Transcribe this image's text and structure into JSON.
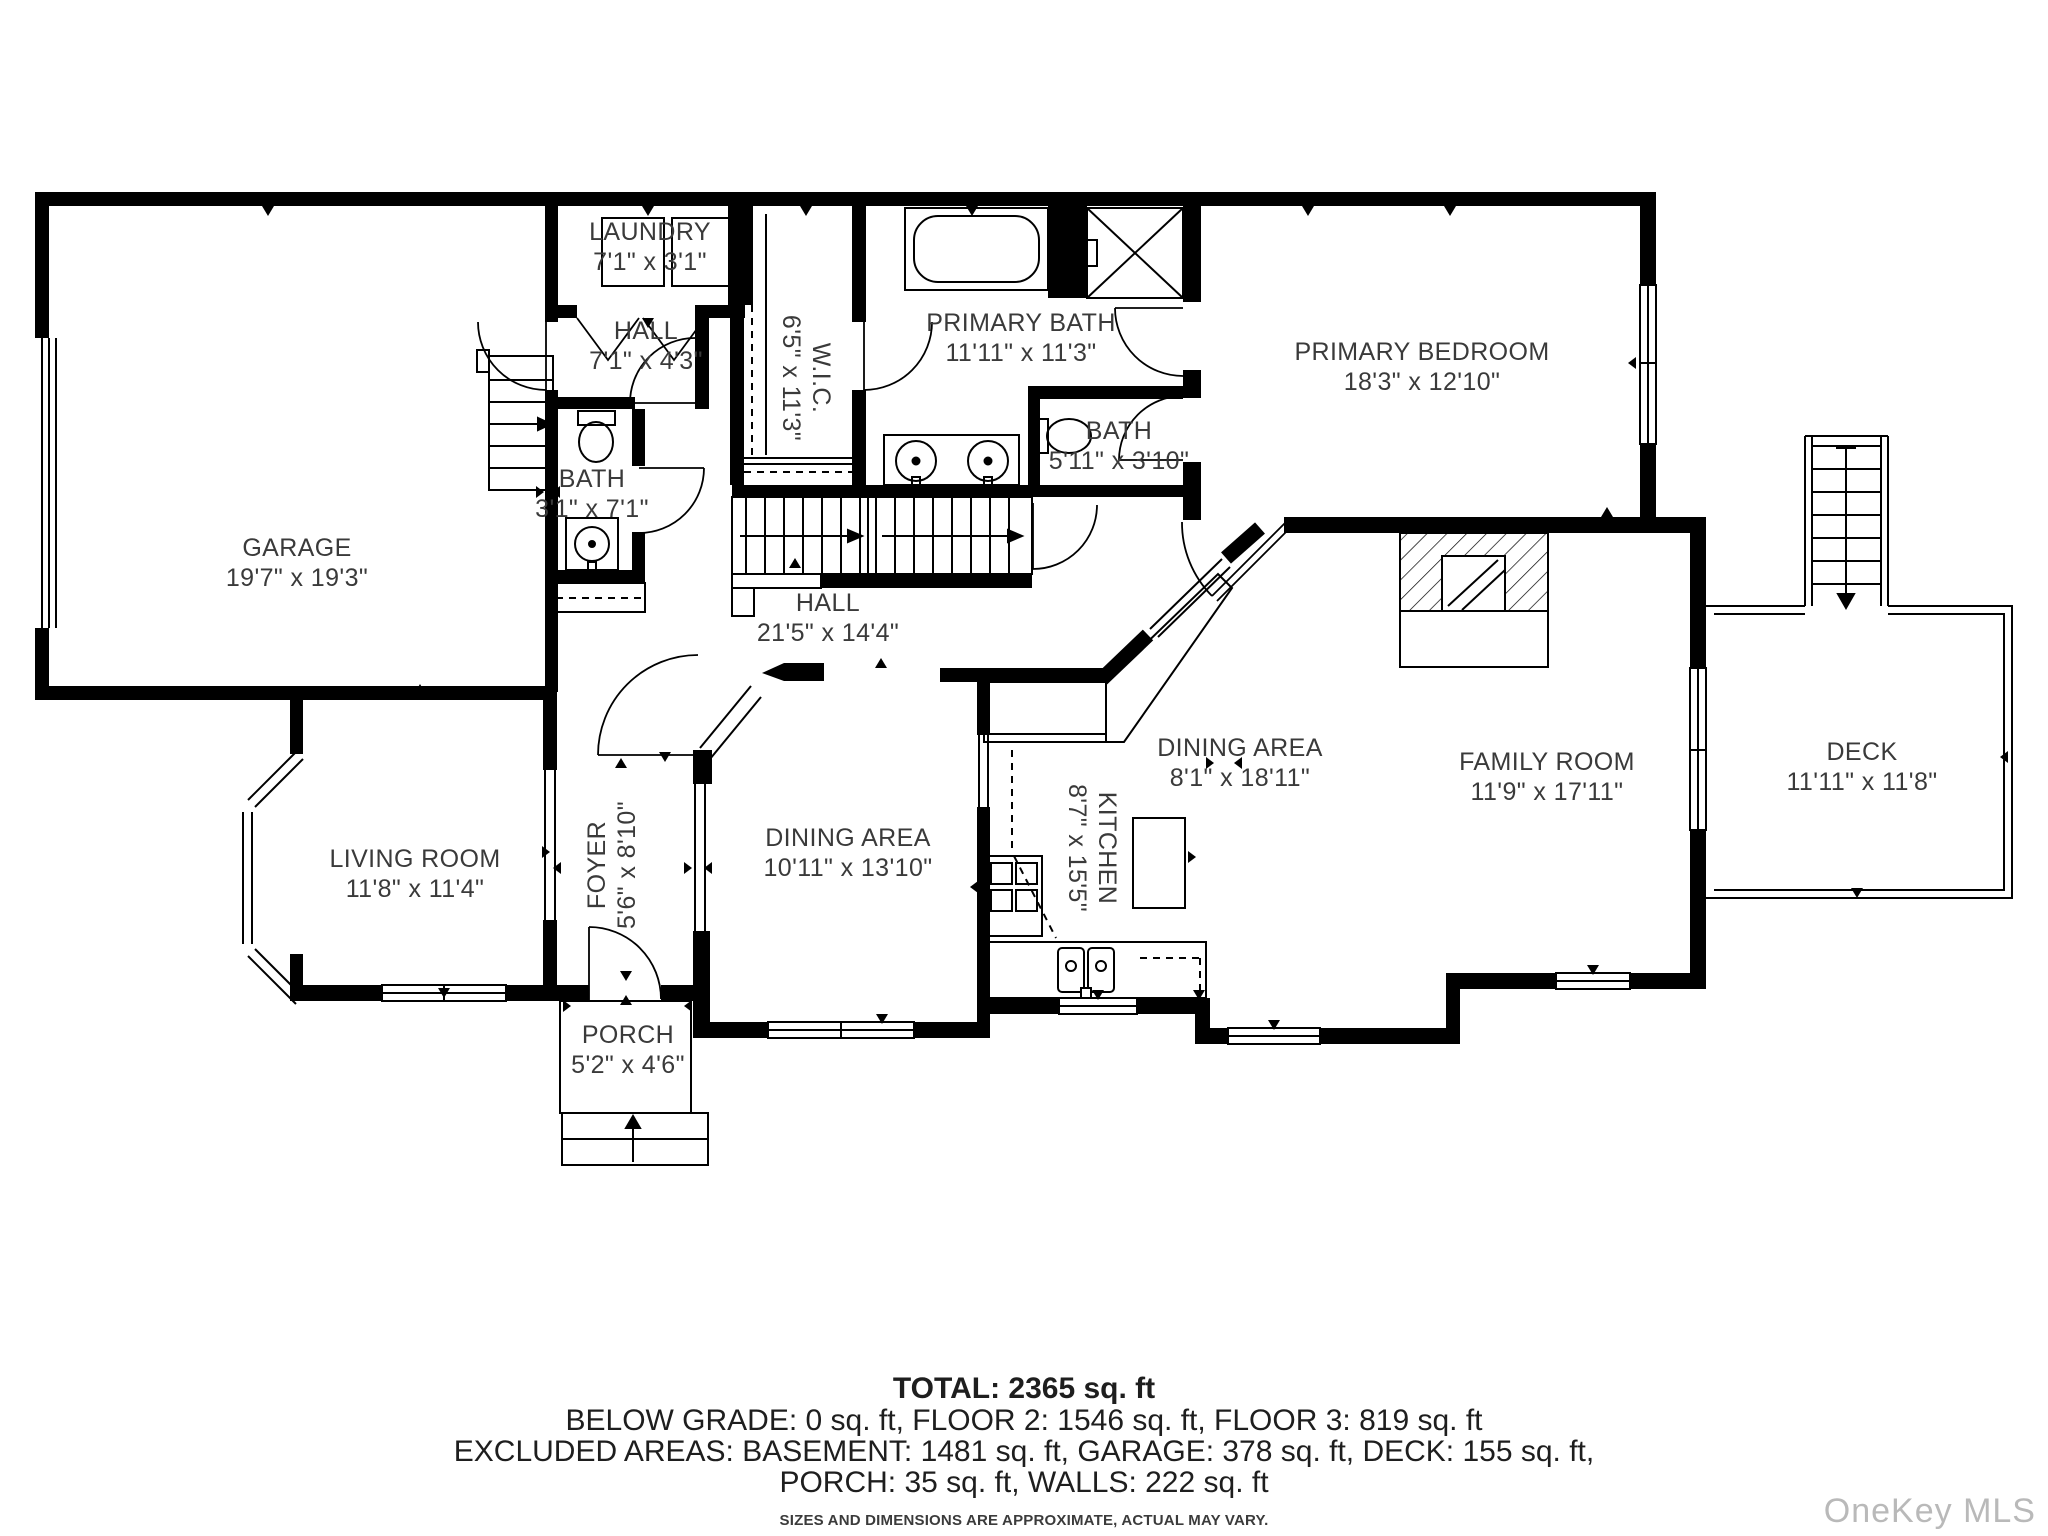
{
  "plan": {
    "rooms": [
      {
        "id": "garage",
        "name": "GARAGE",
        "dims": "19'7\" x 19'3\""
      },
      {
        "id": "laundry",
        "name": "LAUNDRY",
        "dims": "7'1\" x 3'1\""
      },
      {
        "id": "hall-upper",
        "name": "HALL",
        "dims": "7'1\" x 4'3\""
      },
      {
        "id": "bath-1",
        "name": "BATH",
        "dims": "3'1\" x 7'1\""
      },
      {
        "id": "wic",
        "name": "W.I.C.",
        "dims": "6'5\" x 11'3\""
      },
      {
        "id": "primary-bath",
        "name": "PRIMARY BATH",
        "dims": "11'11\" x 11'3\""
      },
      {
        "id": "bath-2",
        "name": "BATH",
        "dims": "5'11\" x 3'10\""
      },
      {
        "id": "primary-bedroom",
        "name": "PRIMARY BEDROOM",
        "dims": "18'3\" x 12'10\""
      },
      {
        "id": "hall-main",
        "name": "HALL",
        "dims": "21'5\" x 14'4\""
      },
      {
        "id": "foyer",
        "name": "FOYER",
        "dims": "5'6\" x 8'10\""
      },
      {
        "id": "living-room",
        "name": "LIVING ROOM",
        "dims": "11'8\" x 11'4\""
      },
      {
        "id": "dining-area-1",
        "name": "DINING AREA",
        "dims": "10'11\" x 13'10\""
      },
      {
        "id": "kitchen",
        "name": "KITCHEN",
        "dims": "8'7\" x 15'5\""
      },
      {
        "id": "dining-area-2",
        "name": "DINING AREA",
        "dims": "8'1\" x 18'11\""
      },
      {
        "id": "family-room",
        "name": "FAMILY ROOM",
        "dims": "11'9\" x 17'11\""
      },
      {
        "id": "deck",
        "name": "DECK",
        "dims": "11'11\" x 11'8\""
      },
      {
        "id": "porch",
        "name": "PORCH",
        "dims": "5'2\" x 4'6\""
      }
    ]
  },
  "summary": {
    "total": "TOTAL: 2365 sq. ft",
    "line2": "BELOW GRADE: 0 sq. ft, FLOOR 2: 1546 sq. ft, FLOOR 3: 819 sq. ft",
    "line3": "EXCLUDED AREAS: BASEMENT: 1481 sq. ft, GARAGE: 378 sq. ft, DECK: 155 sq. ft,",
    "line4": "PORCH: 35 sq. ft, WALLS: 222 sq. ft",
    "disclaimer": "SIZES AND DIMENSIONS ARE APPROXIMATE, ACTUAL MAY VARY."
  },
  "watermark": "OneKey MLS",
  "colors": {
    "wall": "#000000",
    "text": "#3a3a3a",
    "watermark": "#b9b9b9"
  }
}
